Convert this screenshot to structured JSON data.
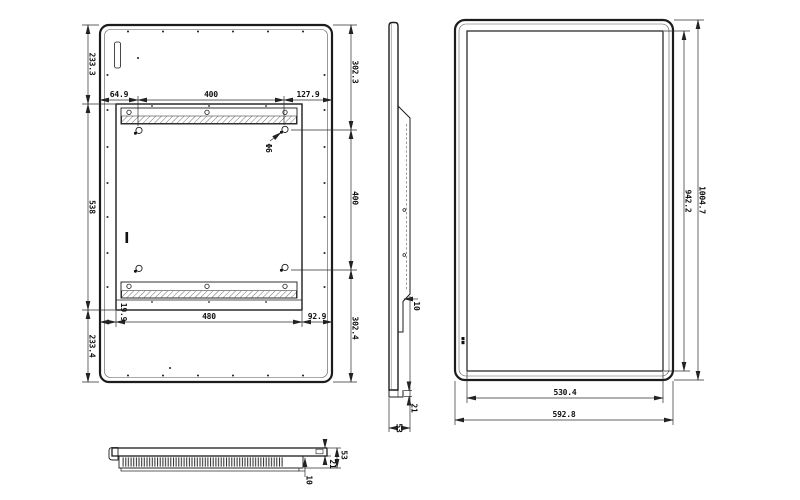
{
  "back_view": {
    "left_chain": {
      "top": "233.3",
      "middle": "538",
      "bottom": "233.4"
    },
    "top_chain": {
      "left": "64.9",
      "middle": "400",
      "right": "127.9"
    },
    "right_chain": {
      "top": "302.3",
      "middle": "400",
      "bottom": "302.4"
    },
    "bottom_chain": {
      "left": "19.9",
      "middle": "480",
      "right": "92.9"
    },
    "hole_label": "Φ6"
  },
  "side_view": {
    "step_depth": "10",
    "front_thickness": "21",
    "total_thickness": "53"
  },
  "front_view": {
    "screen_height": "942.2",
    "total_height": "1004.7",
    "screen_width": "530.4",
    "total_width": "592.8"
  },
  "bottom_view": {
    "front_thickness": "21",
    "total_thickness": "53",
    "vent_depth": "10"
  },
  "colors": {
    "object_line": "#1c1c1c",
    "dimension_line": "#2b2b2b",
    "text": "#111111",
    "background": "#ffffff"
  }
}
